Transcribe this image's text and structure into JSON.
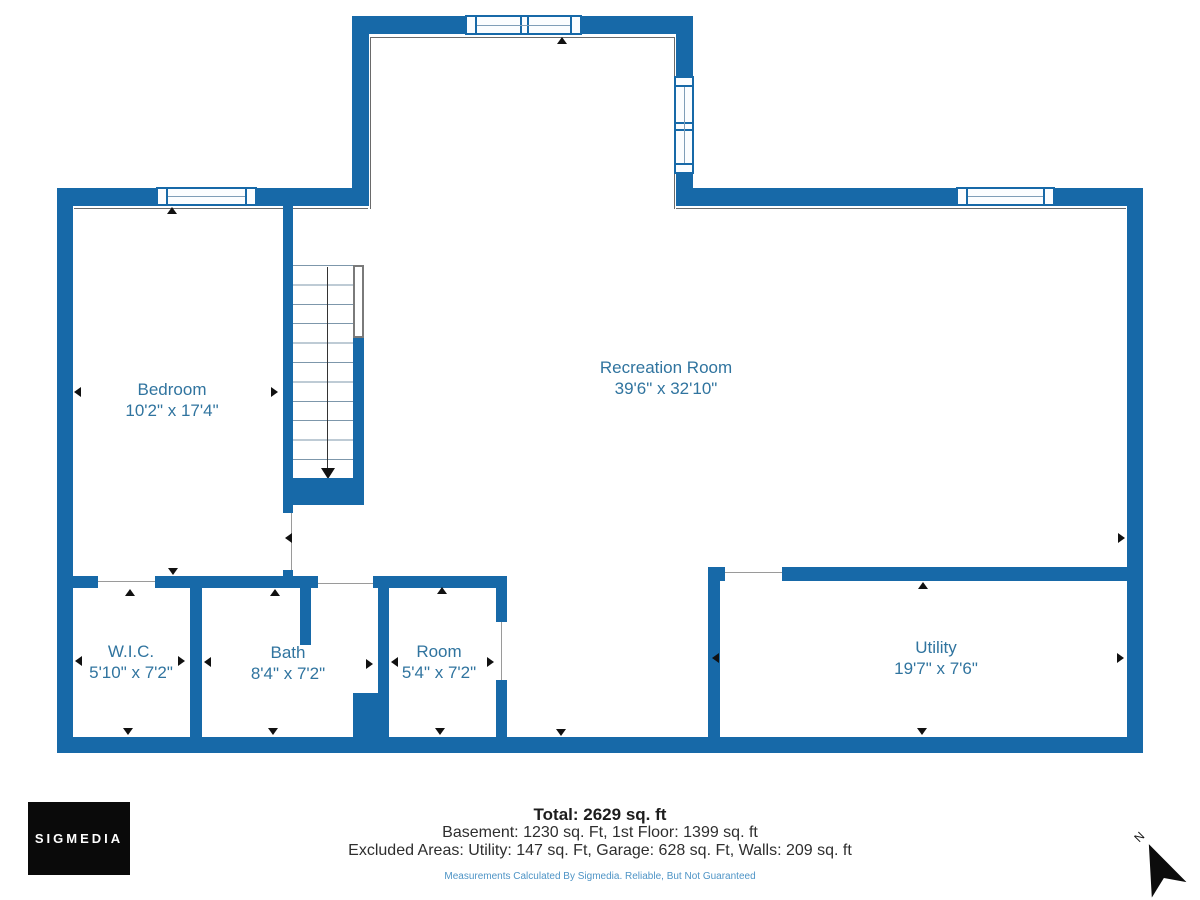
{
  "title": "Basement floor plan",
  "colors": {
    "wall": "#1769a8",
    "room_label": "#30749f",
    "disclaimer": "#4e94c6",
    "logo_bg": "#0a0a0a"
  },
  "rooms": [
    {
      "name": "Bedroom",
      "dimensions": "10'2\" x 17'4\""
    },
    {
      "name": "Recreation Room",
      "dimensions": "39'6\" x 32'10\""
    },
    {
      "name": "W.I.C.",
      "dimensions": "5'10\" x 7'2\""
    },
    {
      "name": "Bath",
      "dimensions": "8'4\" x 7'2\""
    },
    {
      "name": "Room",
      "dimensions": "5'4\" x 7'2\""
    },
    {
      "name": "Utility",
      "dimensions": "19'7\" x 7'6\""
    }
  ],
  "summary": {
    "total": "Total: 2629 sq. ft",
    "line1": "Basement: 1230 sq. Ft, 1st Floor: 1399 sq. ft",
    "line2": "Excluded Areas: Utility: 147 sq. Ft, Garage: 628 sq. Ft, Walls: 209 sq. ft",
    "disclaimer": "Measurements Calculated By Sigmedia. Reliable, But Not Guaranteed"
  },
  "branding": {
    "logo_text": "SIGMEDIA"
  },
  "compass": {
    "label": "N"
  }
}
